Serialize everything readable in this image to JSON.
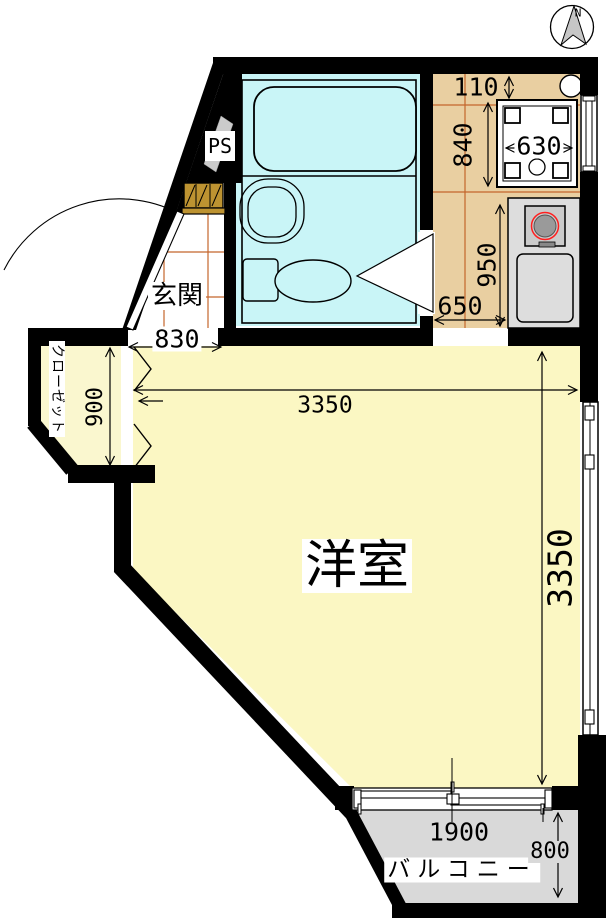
{
  "document": {
    "type": "japanese-apartment-floor-plan"
  },
  "compass": {
    "north_label": "N"
  },
  "rooms": {
    "western_room": {
      "label": "洋室"
    },
    "entrance": {
      "label": "玄関"
    },
    "closet": {
      "label": "クローゼット"
    },
    "balcony": {
      "label": "バルコニー"
    },
    "pipe_space": {
      "label": "PS"
    }
  },
  "dimensions_mm": {
    "top_gap": "110",
    "kitchen_upper_height": "840",
    "washer_pan_width": "630",
    "kitchen_lower_height": "950",
    "kitchen_opening_width": "650",
    "entrance_opening_width": "830",
    "room_width": "3350",
    "room_depth": "3350",
    "closet_depth": "900",
    "balcony_opening_width": "1900",
    "balcony_depth": "800"
  },
  "colors": {
    "bath": "#C9F5F7",
    "room": "#FBF7C3",
    "closet": "#FAF7CF",
    "kitchen": "#E9CFA1",
    "tile": "#C4662C",
    "balcony": "#D9D9D9",
    "counter": "#DDDDDD",
    "stove": "#CBCBCB",
    "burner": "#9A9A9A",
    "burner_ring": "#FF2020",
    "shoebox": "#BD9331",
    "needle": "#C6C6C6",
    "ps_arrow": "#CBCBCB",
    "wall": "#000000"
  }
}
